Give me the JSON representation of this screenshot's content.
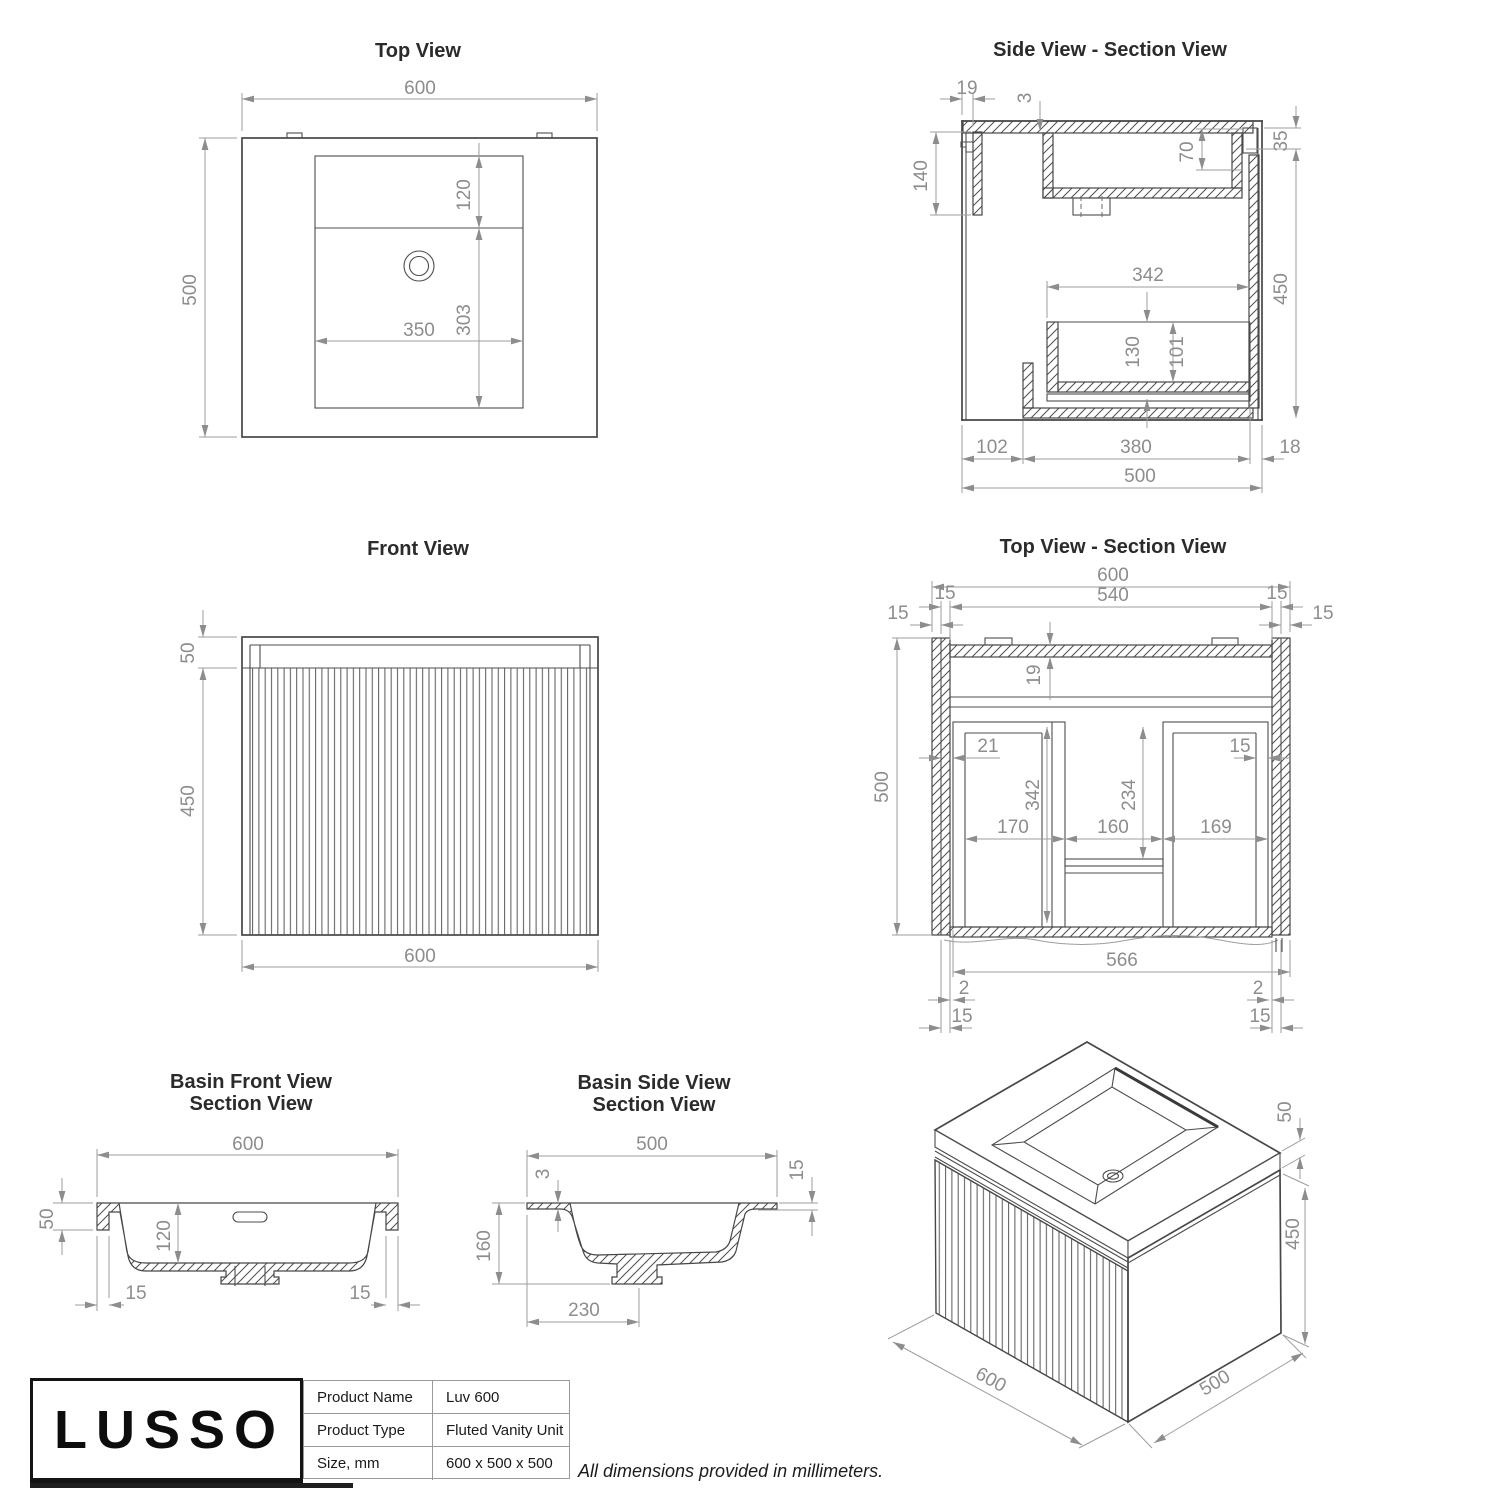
{
  "page": {
    "note": "All dimensions provided in millimeters."
  },
  "views": {
    "top": {
      "title": "Top View",
      "dims": {
        "width": "600",
        "depth": "500",
        "splash": "120",
        "bowl_depth": "303",
        "bowl_width": "350"
      }
    },
    "side_section": {
      "title": "Side View - Section View",
      "dims": {
        "door": "19",
        "gap": "3",
        "rail": "140",
        "bowl_rear": "70",
        "back_step": "35",
        "interior": "342",
        "height": "450",
        "drawer": "130",
        "drawer_inner": "101",
        "front": "102",
        "depth_mid": "380",
        "back": "18",
        "depth": "500"
      }
    },
    "front": {
      "title": "Front View",
      "dims": {
        "counter": "50",
        "body": "450",
        "width": "600"
      }
    },
    "top_section": {
      "title": "Top View - Section View",
      "dims": {
        "width": "600",
        "inner": "540",
        "tl_in": "15",
        "tl_out": "15",
        "tr_in": "15",
        "tr_out": "15",
        "counter": "19",
        "left_gap": "21",
        "right_gap": "15",
        "depth_drawer": "342",
        "depth_runner": "234",
        "left_w": "170",
        "mid_w": "160",
        "right_w": "169",
        "depth": "500",
        "inner_w": "566",
        "bl2": "2",
        "br2": "2",
        "bl15": "15",
        "br15": "15"
      }
    },
    "basin_front": {
      "title_1": "Basin Front View",
      "title_2": "Section View",
      "dims": {
        "width": "600",
        "rim": "50",
        "bowl": "120",
        "left": "15",
        "right": "15"
      }
    },
    "basin_side": {
      "title_1": "Basin Side View",
      "title_2": "Section View",
      "dims": {
        "depth": "500",
        "top": "3",
        "rear": "15",
        "height": "160",
        "drain": "230"
      }
    },
    "iso": {
      "dims": {
        "counter": "50",
        "height": "450",
        "width": "600",
        "depth": "500"
      }
    }
  },
  "title_block": {
    "brand": "LUSSO",
    "rows": [
      {
        "label": "Product Name",
        "value": "Luv 600"
      },
      {
        "label": "Product Type",
        "value": "Fluted Vanity Unit"
      },
      {
        "label": "Size, mm",
        "value": "600 x 500 x 500"
      }
    ]
  }
}
